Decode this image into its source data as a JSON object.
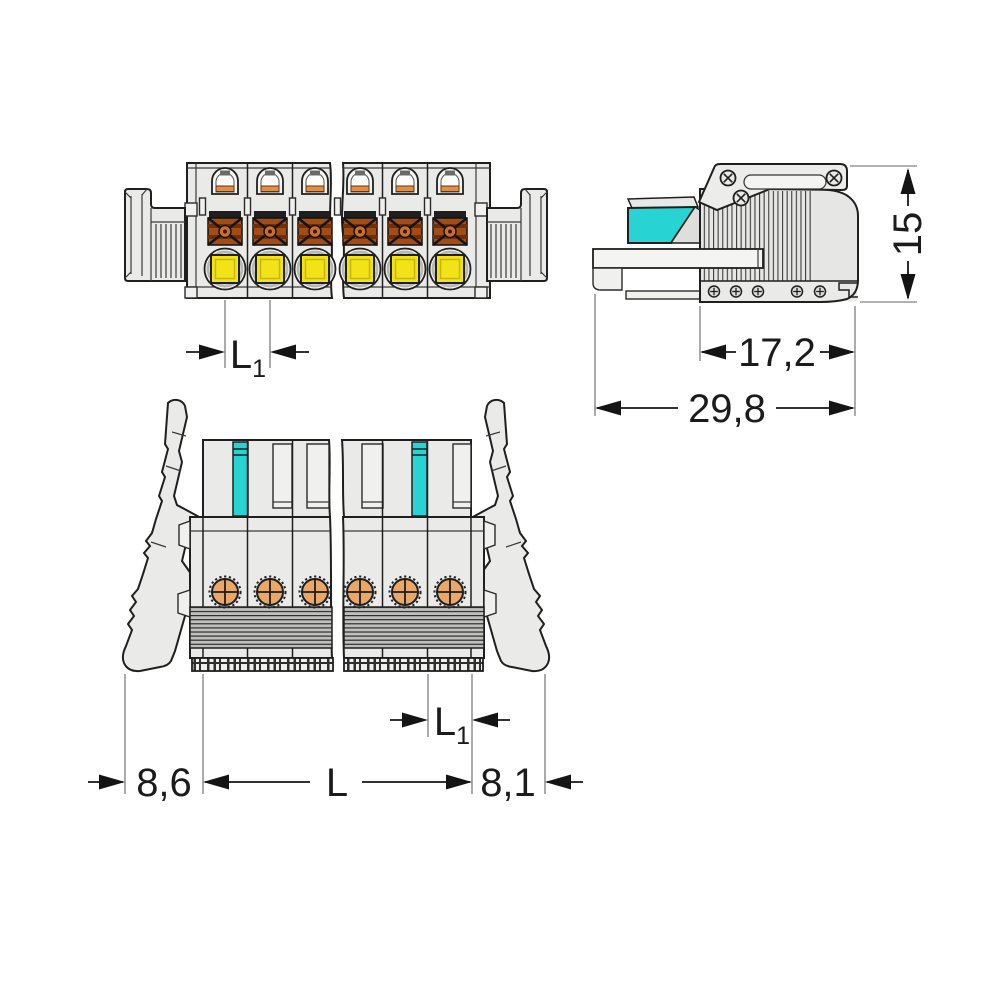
{
  "drawing": {
    "type": "connector-dimension-drawing",
    "colors": {
      "coding_cyan": "#27d3d3",
      "button_yellow": "#f2e318",
      "clamp_copper": "#a34d15",
      "contact_copper": "#e9a868",
      "body_gray": "#eaeae8",
      "line": "#1f1f1f"
    },
    "dimensions": {
      "front_pitch": {
        "base": "L",
        "sub": "1"
      },
      "side_height": "15",
      "side_depth_body": "17,2",
      "side_depth_total": "29,8",
      "bottom_left_offset": "8,6",
      "bottom_length": "L",
      "bottom_pitch": {
        "base": "L",
        "sub": "1"
      },
      "bottom_right_offset": "8,1"
    }
  }
}
